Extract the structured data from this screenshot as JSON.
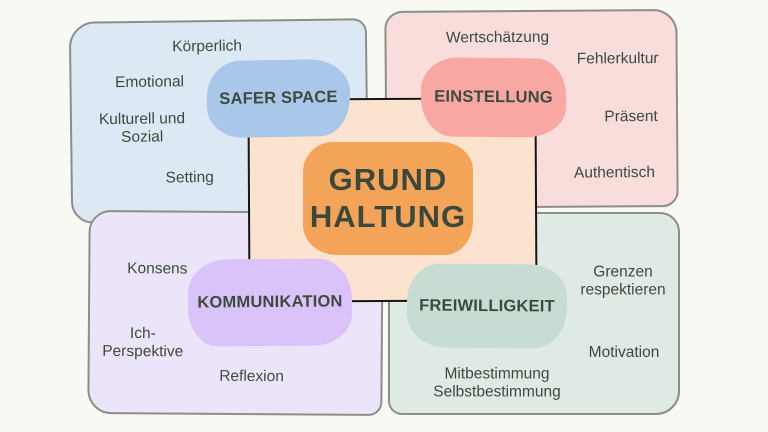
{
  "palette": {
    "background": "#f8f9f2",
    "panel_border": "#8a8f8a",
    "text": "#3c4a40",
    "center_panel": "#fce3d0",
    "center_box": "#f4a458",
    "safer_space_pill": "#a9c7e8",
    "safer_space_panel": "#dce8f3",
    "einstellung_pill": "#f8a7a3",
    "einstellung_panel": "#f8dddb",
    "kommunikation_pill": "#d9c3f8",
    "kommunikation_panel": "#ece4f9",
    "freiwilligkeit_pill": "#c7dcd2",
    "freiwilligkeit_panel": "#e0eae5"
  },
  "center": {
    "title": "GRUND\nHALTUNG"
  },
  "quadrants": {
    "safer_space": {
      "label": "SAFER SPACE",
      "items": [
        "Körperlich",
        "Emotional",
        "Kulturell und\nSozial",
        "Setting"
      ]
    },
    "einstellung": {
      "label": "EINSTELLUNG",
      "items": [
        "Wertschätzung",
        "Fehlerkultur",
        "Präsent",
        "Authentisch"
      ]
    },
    "kommunikation": {
      "label": "KOMMUNIKATION",
      "items": [
        "Konsens",
        "Ich-\nPerspektive",
        "Reflexion"
      ]
    },
    "freiwilligkeit": {
      "label": "FREIWILLIGKEIT",
      "items": [
        "Grenzen\nrespektieren",
        "Motivation",
        "Mitbestimmung\nSelbstbestimmung"
      ]
    }
  }
}
